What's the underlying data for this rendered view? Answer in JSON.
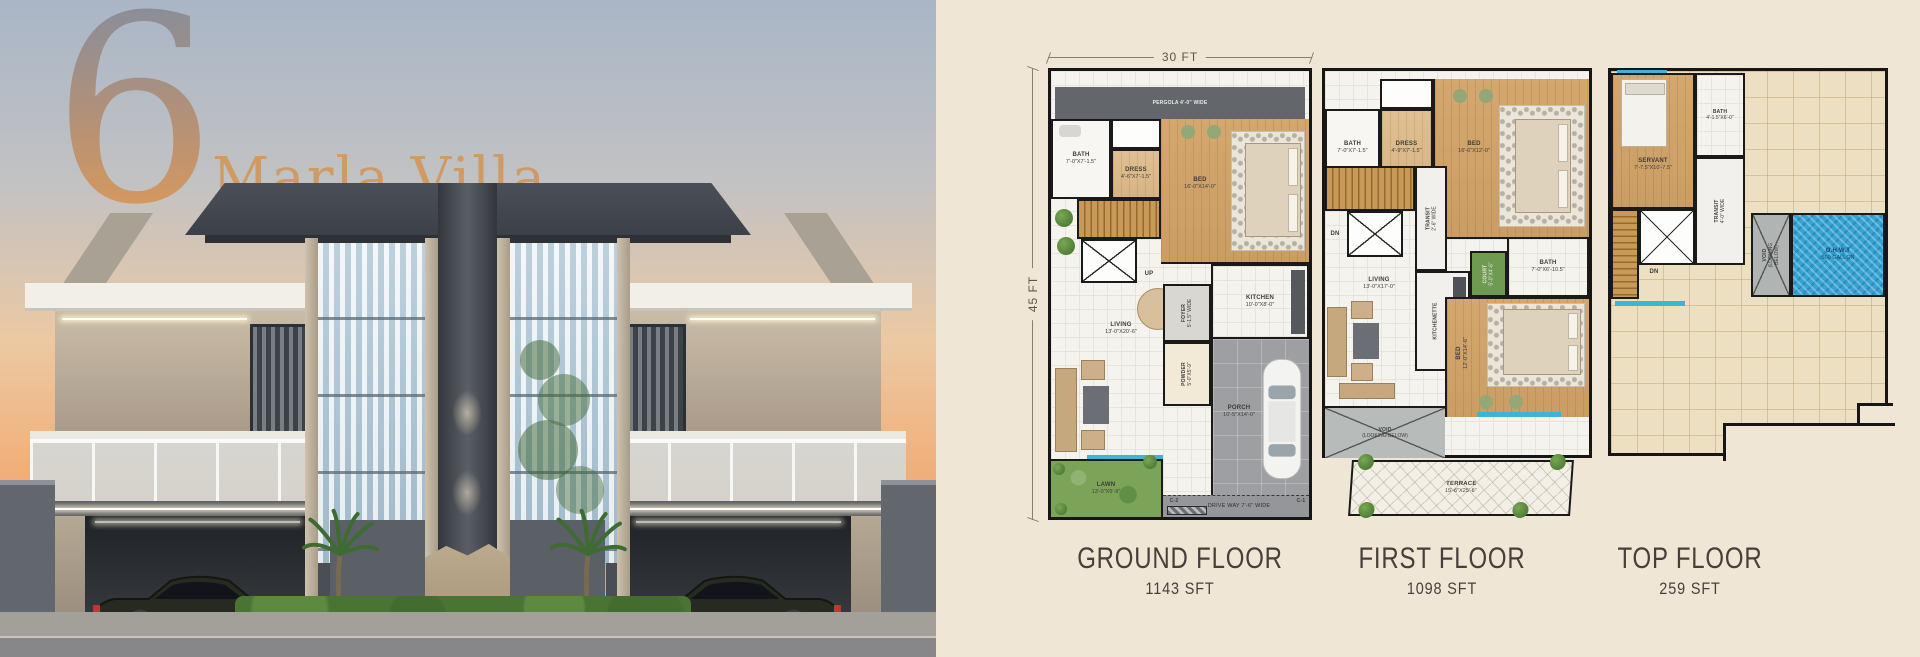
{
  "colors": {
    "panel_bg": "#f0e6d5",
    "wall": "#1a1a1a",
    "window_blue": "#3db4d6",
    "wood_floor": "#cfa06a",
    "lawn_green": "#7ba458",
    "water_blue": "#35a3d4",
    "caption_text": "#46403a",
    "title_orange": "#cf9a63",
    "sunset_orange": "#ef9a5d"
  },
  "hero": {
    "number": "6",
    "name": "Marla Villa"
  },
  "plans": {
    "ground": {
      "caption": "GROUND FLOOR",
      "area": "1143 SFT",
      "width_dim": "30 FT",
      "height_dim": "45 FT",
      "rooms": {
        "pergola": {
          "name": "PERGOLA 4'-0\" WIDE"
        },
        "bath": {
          "name": "BATH",
          "dims": "7'-0\"X7'-1.5\""
        },
        "dress": {
          "name": "DRESS",
          "dims": "4'-6\"X7'-1.5\""
        },
        "bed": {
          "name": "BED",
          "dims": "16'-0\"X14'-0\""
        },
        "up": {
          "name": "UP"
        },
        "kitchen": {
          "name": "KITCHEN",
          "dims": "10'-0\"X8'-0\""
        },
        "living": {
          "name": "LIVING",
          "dims": "13'-0\"X20'-6\""
        },
        "foyer": {
          "name": "FOYER",
          "dims": "5'-1.5\" WIDE"
        },
        "powder": {
          "name": "POWDER",
          "dims": "5'-0\"X5'-9\""
        },
        "porch": {
          "name": "PORCH",
          "dims": "10'-5\"X14'-0\""
        },
        "lawn": {
          "name": "LAWN",
          "dims": "13'-0\"X5'-9\""
        },
        "driveway": {
          "name": "DRIVE WAY 7'-6\" WIDE"
        },
        "c1": {
          "name": "C-1"
        },
        "c2": {
          "name": "C-2"
        }
      }
    },
    "first": {
      "caption": "FIRST FLOOR",
      "area": "1098 SFT",
      "rooms": {
        "bath1": {
          "name": "BATH",
          "dims": "7'-0\"X7'-1.5\""
        },
        "dress": {
          "name": "DRESS",
          "dims": "4'-9\"X7'-1.5\""
        },
        "bed1": {
          "name": "BED",
          "dims": "16'-6\"X12'-0\""
        },
        "dn": {
          "name": "DN"
        },
        "transit": {
          "name": "TRANSIT",
          "dims": "2'-6\" WIDE"
        },
        "kitchenette": {
          "name": "KITCHENETTE"
        },
        "court": {
          "name": "COURT",
          "dims": "5'-0\"X4'-6\""
        },
        "bath2": {
          "name": "BATH",
          "dims": "7'-0\"X6'-10.5\""
        },
        "living": {
          "name": "LIVING",
          "dims": "13'-0\"X17'-0\""
        },
        "bed2": {
          "name": "BED",
          "dims": "12'-0\"X14'-6\""
        },
        "void": {
          "name": "VOID",
          "dims": "(LOOKING BELOW)"
        },
        "terrace": {
          "name": "TERRACE",
          "dims": "15'-6\"X25'-6\""
        }
      }
    },
    "top": {
      "caption": "TOP FLOOR",
      "area": "259 SFT",
      "rooms": {
        "servant": {
          "name": "SERVANT",
          "dims": "7'-7.5\"X10'-7.5\""
        },
        "bath": {
          "name": "BATH",
          "dims": "4'-1.5\"X6'-0\""
        },
        "transit": {
          "name": "TRANSIT",
          "dims": "4'-0\" WIDE"
        },
        "dn": {
          "name": "DN"
        },
        "void": {
          "name": "VOID",
          "dims": "(LOOKING BELOW)"
        },
        "ohwt": {
          "name": "O.H.W.T",
          "dims": "500 GALLON"
        }
      }
    }
  }
}
